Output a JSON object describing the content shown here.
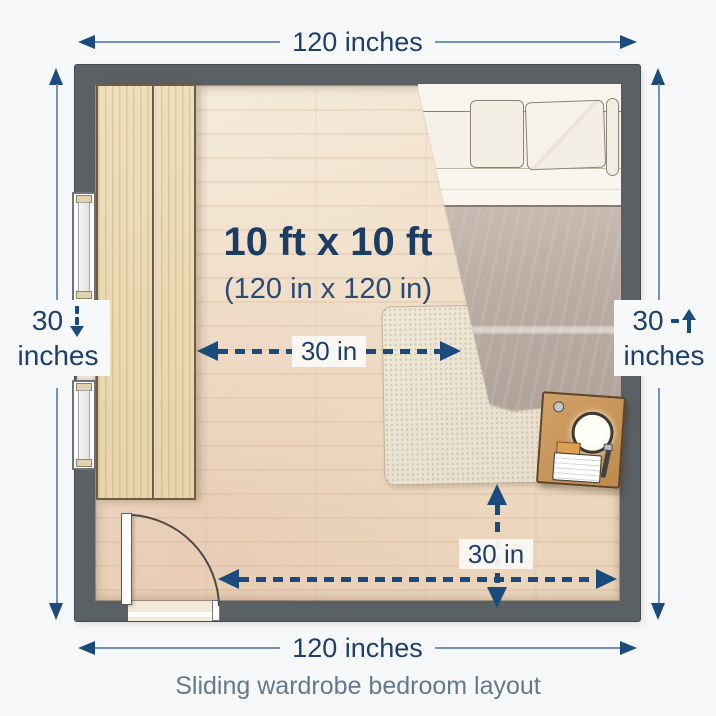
{
  "diagram": {
    "caption": "Sliding wardrobe bedroom layout",
    "room_label": {
      "primary": "10 ft x 10 ft",
      "secondary": "(120 in x 120 in)"
    },
    "dimensions": {
      "top": "120 inches",
      "bottom": "120 inches",
      "left": {
        "value": "30",
        "unit": "inches"
      },
      "right": {
        "value": "30",
        "unit": "inches"
      },
      "clearance_horizontal": "30 in",
      "clearance_vertical": "30 in"
    },
    "furniture": {
      "wardrobe": "sliding wardrobe",
      "bed": "double bed",
      "rug": "rug",
      "nightstand": "nightstand with lamp",
      "door": "hinged door"
    },
    "icons": {
      "left_opening": "dashed-down-arrow",
      "right_wall": "up-arrow"
    },
    "colors": {
      "dimension_navy": "#1b4a7d",
      "dimension_line_blue": "#7591bd",
      "room_text_navy": "#1d3c61",
      "caption_slate": "#64798e",
      "wall_gray": "#5b6065",
      "floor_wood": "#efddc8",
      "wardrobe_wood": "#ead8b3",
      "blanket_taupe": "#b5a89f",
      "rug_cream": "#ebe3d2",
      "nightstand_wood": "#c28c51",
      "background": "#f7f8f9"
    }
  }
}
